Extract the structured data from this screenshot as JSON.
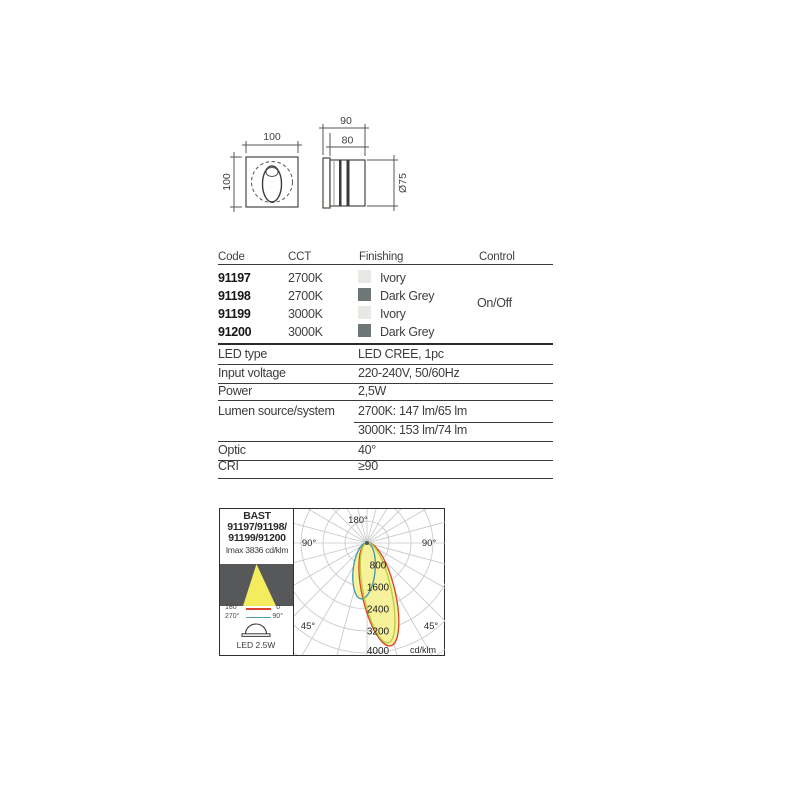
{
  "drawings": {
    "front_view": {
      "width_label": "100",
      "height_label": "100"
    },
    "side_view": {
      "width_label": "90",
      "inner_width_label": "80",
      "diameter_label": "Ø75"
    }
  },
  "table": {
    "headers": {
      "code": "Code",
      "cct": "CCT",
      "finishing": "Finishing",
      "control": "Control"
    },
    "rows": [
      {
        "code": "91197",
        "cct": "2700K",
        "finishing": "Ivory",
        "swatch": "#e9e8e4"
      },
      {
        "code": "91198",
        "cct": "2700K",
        "finishing": "Dark Grey",
        "swatch": "#6f7678"
      },
      {
        "code": "91199",
        "cct": "3000K",
        "finishing": "Ivory",
        "swatch": "#e9e8e4"
      },
      {
        "code": "91200",
        "cct": "3000K",
        "finishing": "Dark Grey",
        "swatch": "#6f7678"
      }
    ],
    "control_value": "On/Off"
  },
  "specs": [
    {
      "label": "LED type",
      "values": [
        "LED CREE, 1pc"
      ]
    },
    {
      "label": "Input voltage",
      "values": [
        "220-240V, 50/60Hz"
      ]
    },
    {
      "label": "Power",
      "values": [
        "2,5W"
      ]
    },
    {
      "label": "Lumen source/system",
      "values": [
        "2700K: 147 lm/65 lm",
        "3000K: 153 lm/74 lm"
      ]
    },
    {
      "label": "Optic",
      "values": [
        "40°"
      ]
    },
    {
      "label": "CRI",
      "values": [
        "≥90"
      ]
    }
  ],
  "photometry": {
    "family": "BAST",
    "codes_line1": "91197/91198/",
    "codes_line2": "91199/91200",
    "imax": "Imax 3836 cd/klm",
    "legend": [
      {
        "left": "180°",
        "right": "0°",
        "color": "#d8442e"
      },
      {
        "left": "270°",
        "right": "90°",
        "color": "#4b9bb5"
      }
    ],
    "lamp": "LED 2.5W",
    "beam_color": "#f4ec5f",
    "panel_bg": "#57585a"
  },
  "chart_data": {
    "type": "polar",
    "title": "Luminous intensity distribution BAST 91197/91198/91199/91200",
    "unit": "cd/klm",
    "imax_cd_klm": 3836,
    "ring_step": 800,
    "rings": [
      800,
      1600,
      2400,
      3200,
      4000
    ],
    "angle_labels": {
      "top": "180°",
      "left90": "90°",
      "right90": "90°",
      "left45": "45°",
      "right45": "45°"
    },
    "grid_color": "#c9c9c9",
    "fill_color": "#f6f19b",
    "series": [
      {
        "name": "C0-C180 plane",
        "color": "#d8442e",
        "tilt_deg": 13,
        "max_cd_klm": 3836,
        "width_cd_klm": 1200,
        "filled": true
      },
      {
        "name": "C90-C270 plane",
        "color": "#3f96ab",
        "tilt_deg": -6,
        "max_cd_klm": 2040,
        "width_cd_klm": 800,
        "filled": true
      },
      {
        "name": "C45-C225 plane",
        "color": "#b9cc3f",
        "tilt_deg": 12,
        "max_cd_klm": 3710,
        "width_cd_klm": 1020,
        "filled": false
      }
    ]
  }
}
